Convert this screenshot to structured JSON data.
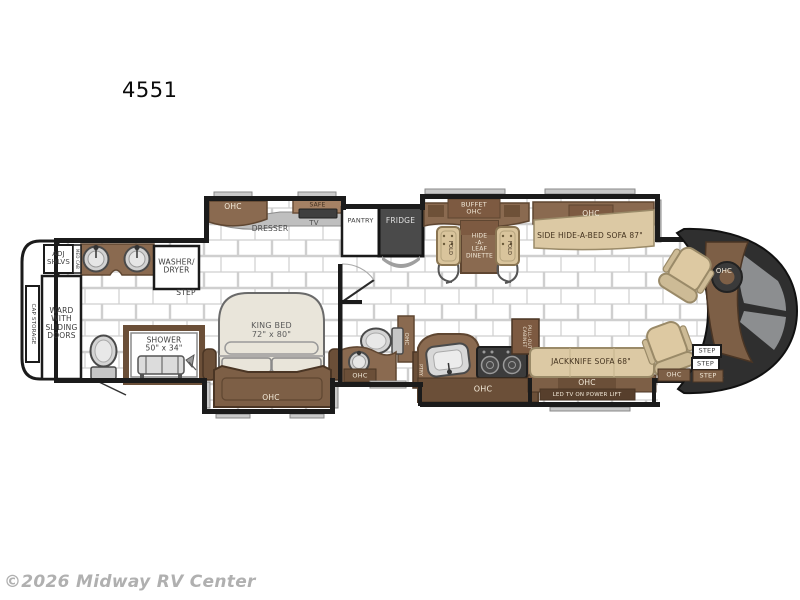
{
  "title": "4551",
  "watermark": "©2026 Midway RV Center",
  "floorplan": {
    "rear": {
      "cap_storage": "CAP STORAGE",
      "adj_shlvs": "ADJ\nSHLVS",
      "med_cab": "MED CAB",
      "washer_dryer": "WASHER/\nDRYER",
      "step": "STEP",
      "ward": "WARD\nWITH\nSLIDING\nDOORS",
      "shower": "SHOWER\n50\" x 34\""
    },
    "bedroom": {
      "ohc": "OHC",
      "safe": "SAFE",
      "dresser": "DRESSER",
      "tv": "TV",
      "king_bed": "KING BED\n72\" x 80\"",
      "ohc_foot": "OHC"
    },
    "galley": {
      "pantry": "PANTRY",
      "fridge": "FRIDGE",
      "buffet_ohc": "BUFFET\nOHC",
      "dinette": "HIDE\n-A-\nLEAF\nDINETTE",
      "fold_left": "FOLD",
      "fold_right": "FOLD",
      "ohc": "OHC",
      "pull_out_cabinet": "PULL-OUT\nCABINET",
      "ptry": "PTRY"
    },
    "bath": {
      "ohc_vert": "OHC",
      "ohc_sink": "OHC"
    },
    "living": {
      "sofa_top_ohc": "OHC",
      "side_sofa": "SIDE HIDE-A-BED SOFA 87\"",
      "jackknife_sofa": "JACKKNIFE SOFA 68\"",
      "sofa_ohc": "OHC",
      "led_tv": "LED TV ON POWER LIFT"
    },
    "front": {
      "ohc_bottom": "OHC",
      "dash_ohc": "OHC",
      "steps": [
        "STEP",
        "STEP",
        "STEP"
      ]
    }
  }
}
